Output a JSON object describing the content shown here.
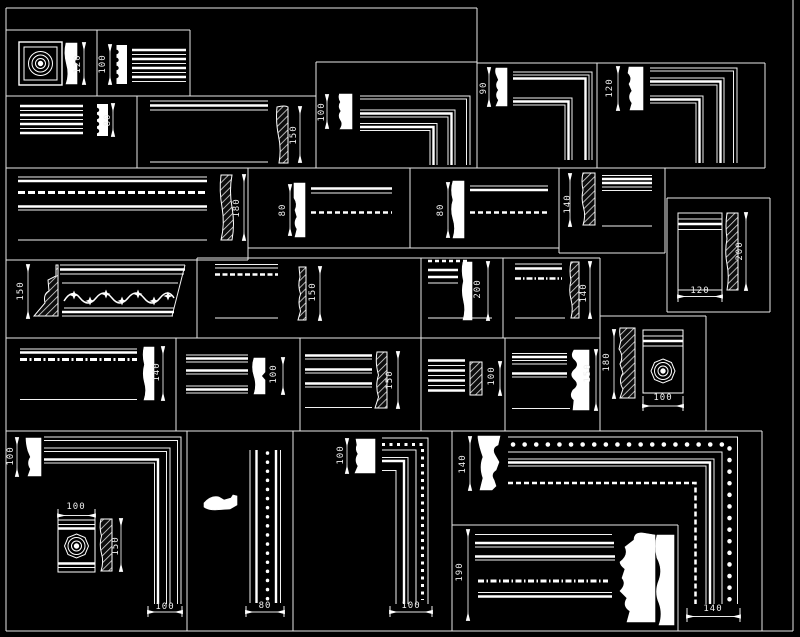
{
  "drawing": {
    "description": "CAD molding and cornice profile block library",
    "colors": {
      "background": "#000000",
      "line": "#ffffff",
      "dim_text": "#efefef"
    }
  },
  "panels": [
    {
      "name": "square-rosette-block",
      "dims": [
        {
          "value": "120",
          "orientation": "vertical"
        }
      ]
    },
    {
      "name": "dentil-strip-molding",
      "dims": [
        {
          "value": "100",
          "orientation": "vertical"
        }
      ]
    },
    {
      "name": "dentil-strip-molding-2",
      "dims": [
        {
          "value": "80",
          "orientation": "vertical"
        }
      ]
    },
    {
      "name": "plain-molding",
      "dims": [
        {
          "value": "150",
          "orientation": "vertical"
        }
      ]
    },
    {
      "name": "corner-molding-small",
      "dims": [
        {
          "value": "100",
          "orientation": "vertical"
        }
      ]
    },
    {
      "name": "corner-molding-90",
      "dims": [
        {
          "value": "90",
          "orientation": "vertical"
        }
      ]
    },
    {
      "name": "corner-molding-120",
      "dims": [
        {
          "value": "120",
          "orientation": "vertical"
        }
      ]
    },
    {
      "name": "beaded-cornice-wide",
      "dims": [
        {
          "value": "180",
          "orientation": "vertical"
        }
      ]
    },
    {
      "name": "beaded-molding-a",
      "dims": [
        {
          "value": "80",
          "orientation": "vertical"
        }
      ]
    },
    {
      "name": "beaded-molding-b",
      "dims": [
        {
          "value": "80",
          "orientation": "vertical"
        }
      ]
    },
    {
      "name": "striped-molding-140",
      "dims": [
        {
          "value": "140",
          "orientation": "vertical"
        }
      ]
    },
    {
      "name": "panel-molding-block",
      "dims": [
        {
          "value": "200",
          "orientation": "vertical"
        },
        {
          "value": "120",
          "orientation": "horizontal"
        }
      ]
    },
    {
      "name": "floral-cornice",
      "dims": [
        {
          "value": "150",
          "orientation": "vertical"
        }
      ]
    },
    {
      "name": "beaded-molding-150",
      "dims": [
        {
          "value": "150",
          "orientation": "vertical"
        }
      ]
    },
    {
      "name": "layered-molding-200",
      "dims": [
        {
          "value": "200",
          "orientation": "vertical"
        }
      ]
    },
    {
      "name": "beaded-molding-140",
      "dims": [
        {
          "value": "140",
          "orientation": "vertical"
        }
      ]
    },
    {
      "name": "striped-molding-row4-a",
      "dims": [
        {
          "value": "140",
          "orientation": "vertical"
        }
      ]
    },
    {
      "name": "striped-molding-row4-b",
      "dims": [
        {
          "value": "100",
          "orientation": "vertical"
        }
      ]
    },
    {
      "name": "striped-molding-row4-c",
      "dims": [
        {
          "value": "150",
          "orientation": "vertical"
        }
      ]
    },
    {
      "name": "striped-molding-row4-d",
      "dims": [
        {
          "value": "100",
          "orientation": "vertical"
        }
      ]
    },
    {
      "name": "striped-molding-row4-e",
      "dims": [
        {
          "value": "150",
          "orientation": "vertical"
        }
      ]
    },
    {
      "name": "rosette-block-molding",
      "dims": [
        {
          "value": "180",
          "orientation": "vertical"
        },
        {
          "value": "100",
          "orientation": "horizontal"
        }
      ]
    },
    {
      "name": "corner-with-rosette",
      "dims": [
        {
          "value": "100",
          "orientation": "vertical"
        },
        {
          "value": "100",
          "orientation": "horizontal"
        },
        {
          "value": "150",
          "orientation": "vertical"
        },
        {
          "value": "100",
          "orientation": "horizontal"
        }
      ]
    },
    {
      "name": "beaded-vertical-strip",
      "dims": [
        {
          "value": "80",
          "orientation": "horizontal"
        }
      ]
    },
    {
      "name": "beaded-corner",
      "dims": [
        {
          "value": "100",
          "orientation": "vertical"
        },
        {
          "value": "100",
          "orientation": "horizontal"
        }
      ]
    },
    {
      "name": "beaded-corner-large",
      "dims": [
        {
          "value": "140",
          "orientation": "vertical"
        },
        {
          "value": "190",
          "orientation": "vertical"
        },
        {
          "value": "140",
          "orientation": "horizontal"
        }
      ]
    }
  ]
}
